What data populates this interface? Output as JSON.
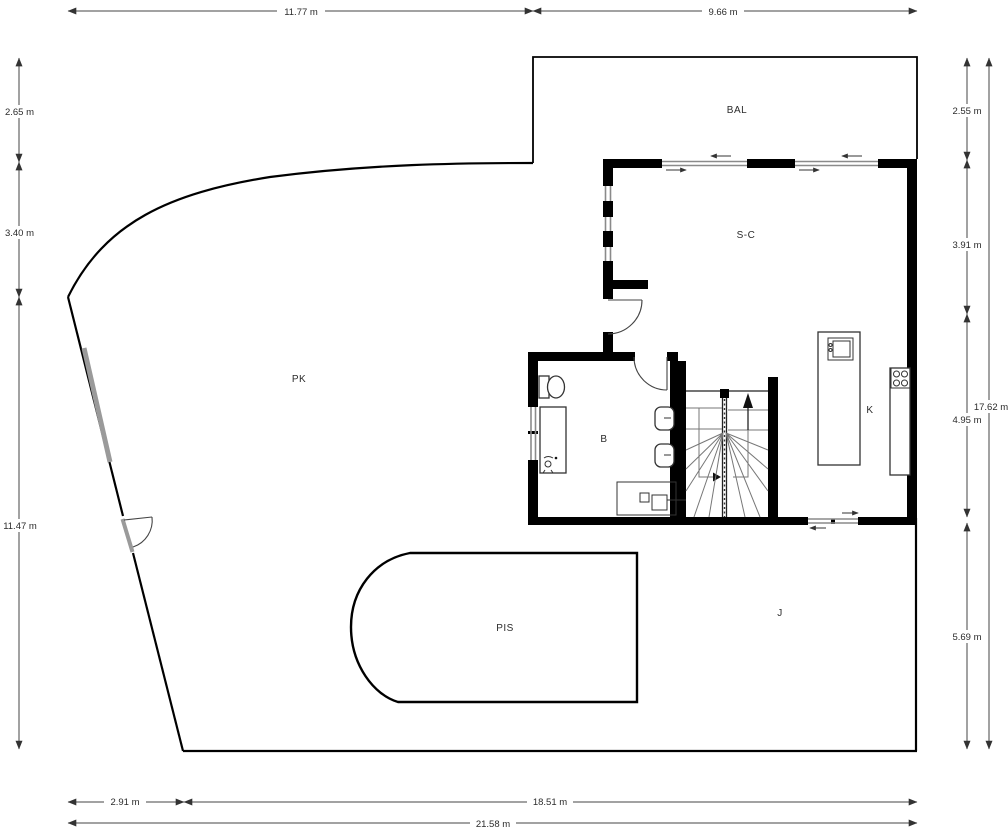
{
  "title": "Floor plan with site boundary and dimensions",
  "rooms": {
    "balcony": "BAL",
    "living": "S-C",
    "parking": "PK",
    "bathroom": "B",
    "kitchen": "K",
    "garden": "J",
    "pool": "PIS"
  },
  "dims": {
    "top_left": "11.77 m",
    "top_right": "9.66 m",
    "left_top": "2.65 m",
    "left_mid": "3.40 m",
    "left_bottom": "11.47 m",
    "right_1": "2.55 m",
    "right_2": "3.91 m",
    "right_3": "4.95 m",
    "right_4": "5.69 m",
    "right_total": "17.62 m",
    "bottom_gate": "2.91 m",
    "bottom_main": "18.51 m",
    "bottom_total": "21.58 m"
  },
  "colors": {
    "wall": "#000000",
    "window": "#8a8a8a",
    "fence": "#9a9a9a",
    "dim": "#444444",
    "text": "#2b2b2b",
    "background": "#ffffff"
  }
}
